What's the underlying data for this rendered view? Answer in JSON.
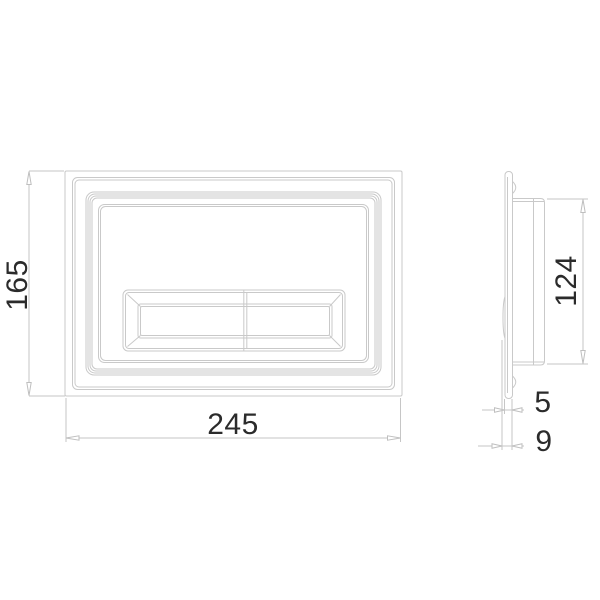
{
  "drawing": {
    "title": "flush-plate-dimension-drawing",
    "background_color": "#ffffff",
    "line_color": "#c9c9c9",
    "text_color": "#2b2b2b",
    "views": {
      "front": {
        "name": "front-view-plate-with-dual-flush-button"
      },
      "side": {
        "name": "side-profile-view"
      }
    },
    "dimensions": {
      "overall_height": "165",
      "overall_width": "245",
      "housing_height": "124",
      "plate_thickness": "5",
      "total_depth": "9"
    }
  }
}
